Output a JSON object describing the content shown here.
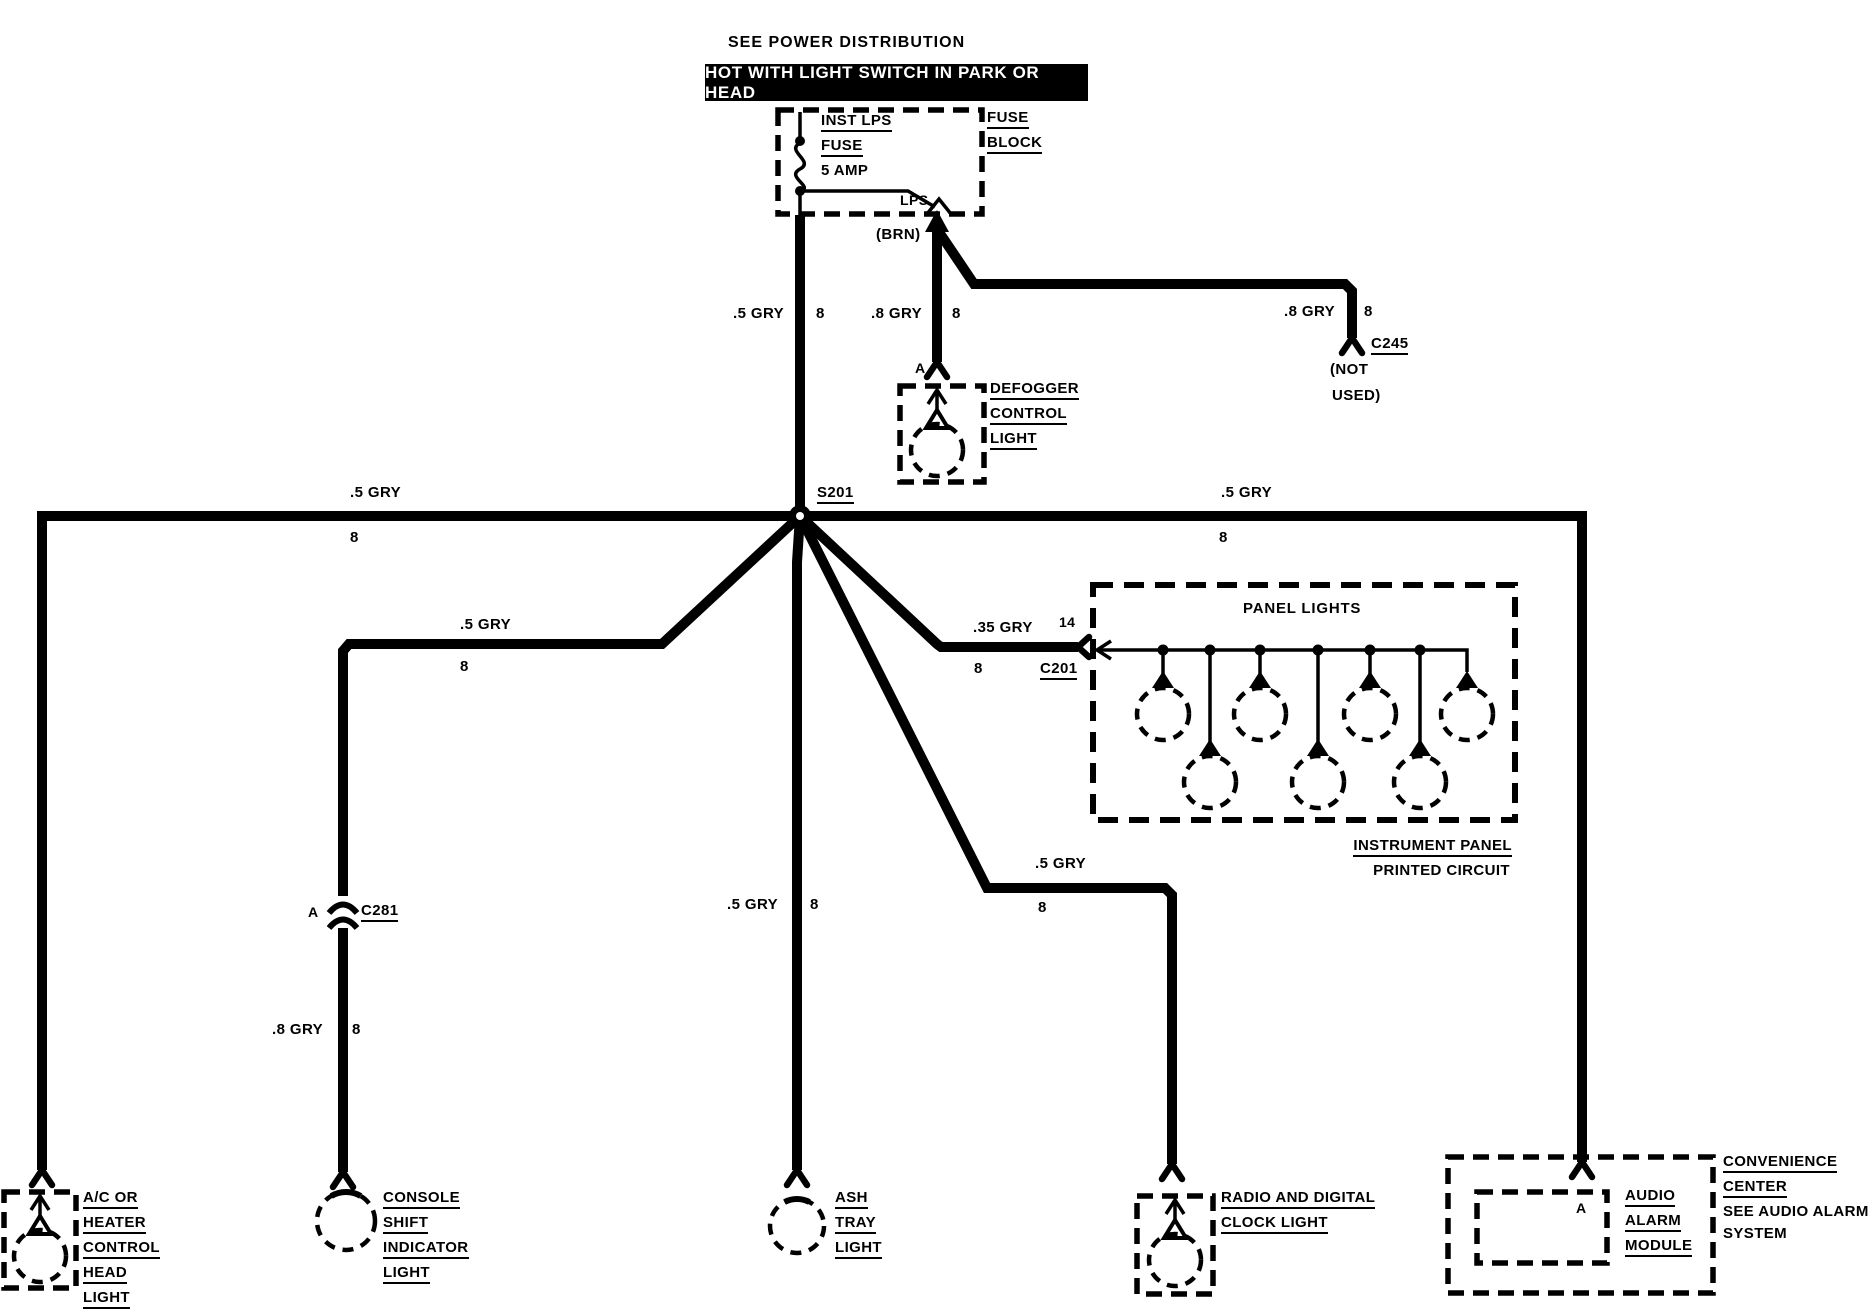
{
  "header": {
    "see_power": "SEE POWER DISTRIBUTION",
    "banner": "HOT WITH LIGHT SWITCH IN PARK OR HEAD"
  },
  "fuse_block": {
    "name_line1": "FUSE",
    "name_line2": "BLOCK",
    "fuse_line1": "INST LPS",
    "fuse_line2": "FUSE",
    "rating": "5 AMP",
    "terminal": "LPS",
    "wire_color": "(BRN)"
  },
  "splice_id": "S201",
  "wires": {
    "main": {
      "gauge": ".5 GRY",
      "circuit": "8"
    },
    "defogger": {
      "gauge": ".8 GRY",
      "circuit": "8",
      "pin": "A"
    },
    "c245": {
      "gauge": ".8 GRY",
      "circuit": "8",
      "connector": "C245",
      "note_line1": "(NOT",
      "note_line2": "USED)"
    },
    "left_bus": {
      "gauge": ".5 GRY",
      "circuit": "8"
    },
    "right_bus": {
      "gauge": ".5 GRY",
      "circuit": "8"
    },
    "console": {
      "gauge": ".5 GRY",
      "circuit": "8",
      "pin": "A",
      "connector": "C281",
      "gauge2": ".8 GRY",
      "circuit2": "8"
    },
    "ashtray": {
      "gauge": ".5 GRY",
      "circuit": "8"
    },
    "panel": {
      "gauge": ".35 GRY",
      "circuit": "8",
      "pin": "14",
      "connector": "C201"
    },
    "radio": {
      "gauge": ".5 GRY",
      "circuit": "8"
    }
  },
  "components": {
    "defogger_light": {
      "name": [
        "DEFOGGER",
        "CONTROL",
        "LIGHT"
      ]
    },
    "panel_lights": {
      "title": "PANEL LIGHTS",
      "caption_line1": "INSTRUMENT PANEL",
      "caption_line2": "PRINTED CIRCUIT"
    },
    "ac_light": {
      "name": [
        "A/C OR",
        "HEATER",
        "CONTROL",
        "HEAD",
        "LIGHT"
      ]
    },
    "console_light": {
      "name": [
        "CONSOLE",
        "SHIFT",
        "INDICATOR",
        "LIGHT"
      ]
    },
    "ashtray_light": {
      "name": [
        "ASH",
        "TRAY",
        "LIGHT"
      ]
    },
    "radio_light": {
      "name": [
        "RADIO AND DIGITAL",
        "CLOCK LIGHT"
      ]
    },
    "audio_alarm": {
      "pin": "A",
      "name": [
        "AUDIO",
        "ALARM",
        "MODULE"
      ],
      "note": [
        "CONVENIENCE",
        "CENTER",
        "SEE AUDIO ALARM",
        "SYSTEM"
      ]
    }
  },
  "colors": {
    "ink": "#000000",
    "paper": "#ffffff"
  }
}
